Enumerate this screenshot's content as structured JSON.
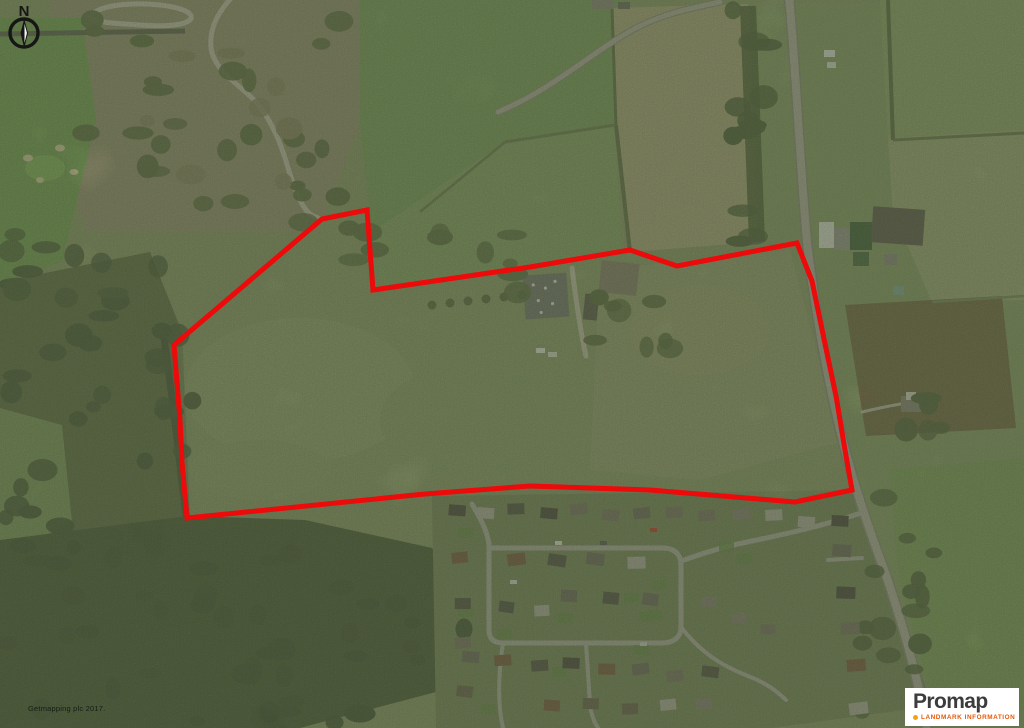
{
  "map": {
    "type": "aerial-photograph",
    "attribution": "Getmapping plc 2017.",
    "compass": {
      "label": "N"
    },
    "boundary": {
      "color": "#ec0a0a",
      "points": "322,219 367,210 373,290 530,267 630,250 677,266 797,243 812,281 824,339 836,396 845,450 852,490 795,502 650,490 530,486 425,494 187,518 182,462 180,420 174,345"
    }
  },
  "logo": {
    "brand": "Promap",
    "subtitle": "LANDMARK INFORMATION",
    "brand_color": "#3c3c3c",
    "subtitle_color": "#e5590b",
    "dot_color": "#f4a30e"
  }
}
